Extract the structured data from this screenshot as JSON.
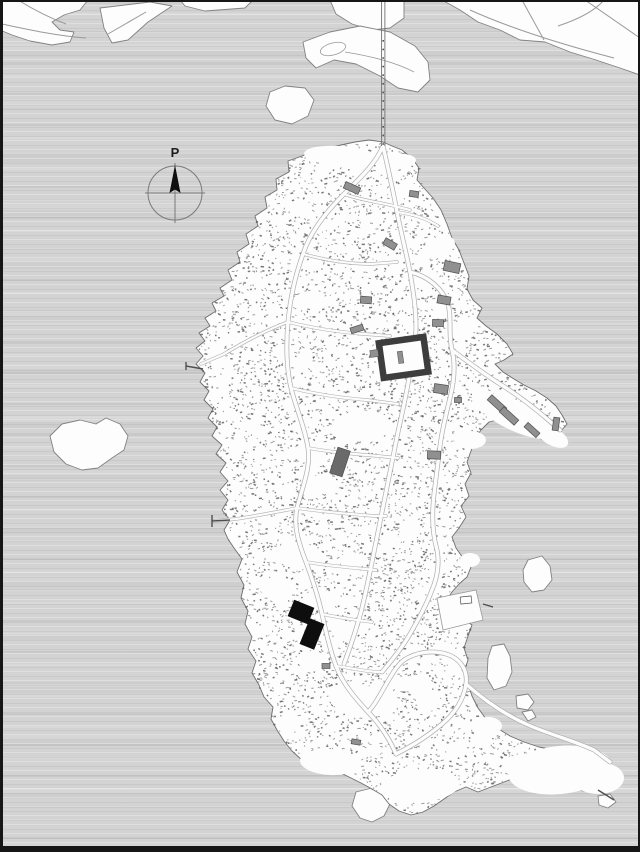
{
  "map": {
    "type": "island-site-plan",
    "north_arrow_label": "P"
  },
  "colors": {
    "water": "#d3d3d3",
    "land": "#fdfdfd",
    "coastline": "#828282",
    "vegetation": "#747474",
    "vegetation_dark": "#585858",
    "road_casing": "#aeaeae",
    "road_fill": "#fcfcfc",
    "building_gray": "#909090",
    "building_outline": "#4f4f4f",
    "building_dark": "#6a6a6a",
    "courtyard_dark": "#3d3d3d",
    "highlight_black": "#0e0e0e",
    "frame": "#161616"
  }
}
